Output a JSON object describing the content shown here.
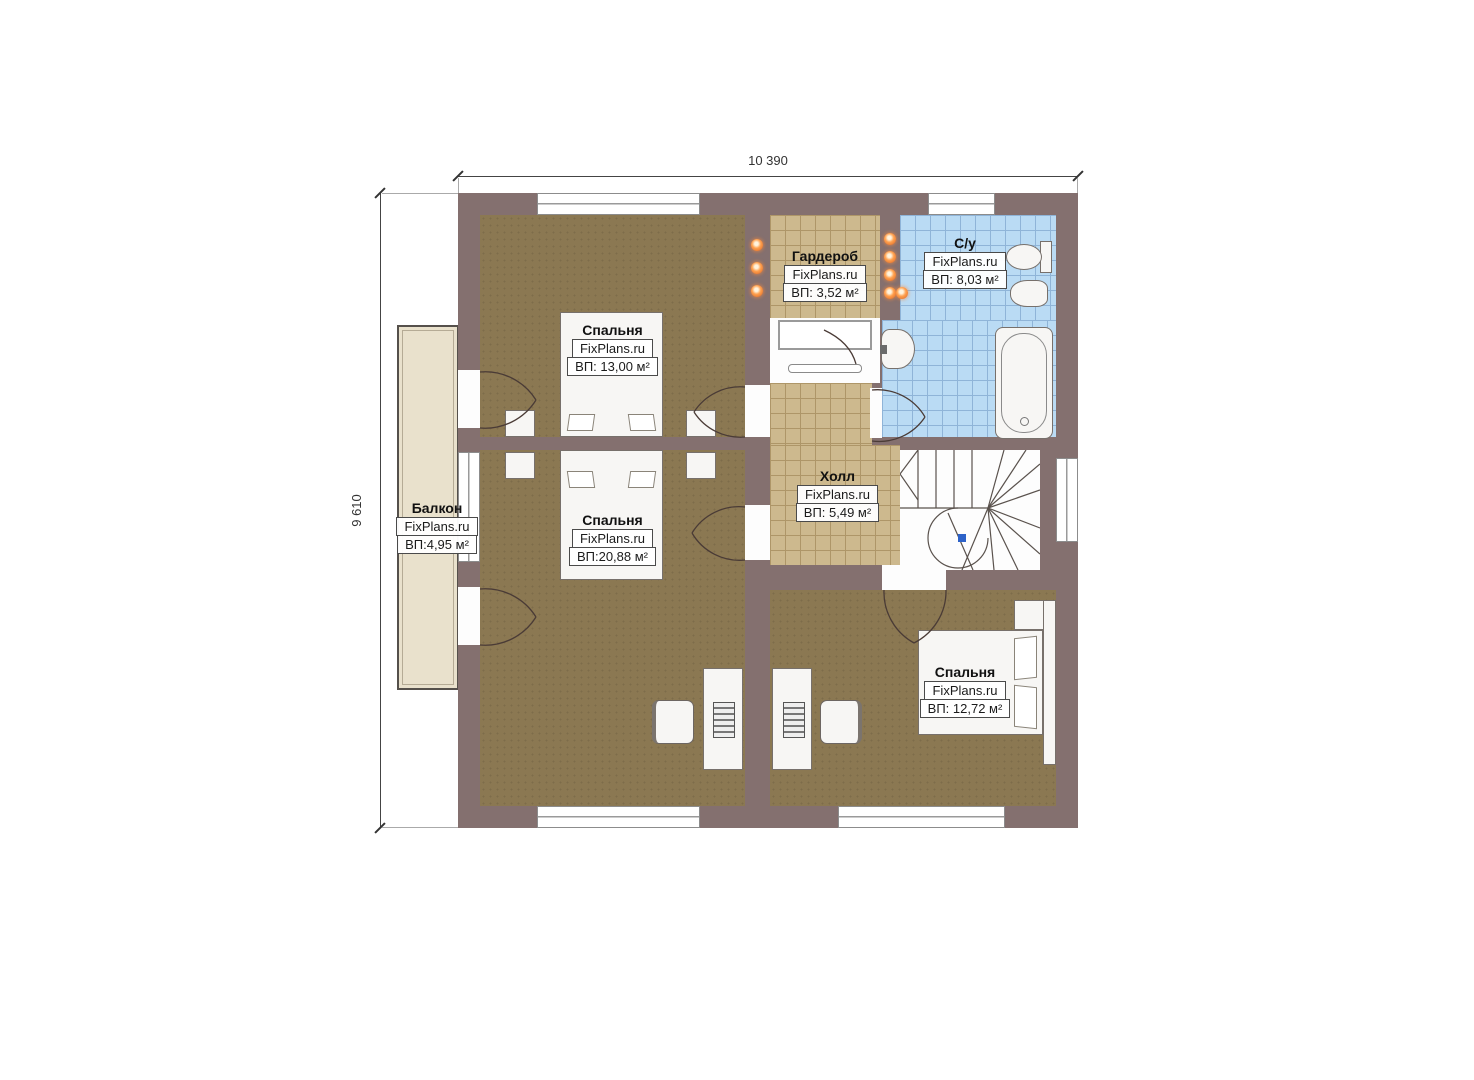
{
  "plan": {
    "type": "floor-plan",
    "dimensions": {
      "width_label": "10 390",
      "height_label": "9 610"
    },
    "watermark": "FixPlans.ru",
    "rooms": {
      "bedroom_top": {
        "name": "Спальня",
        "area": "ВП: 13,00 м²"
      },
      "bedroom_mid": {
        "name": "Спальня",
        "area": "ВП:20,88 м²"
      },
      "wardrobe": {
        "name": "Гардероб",
        "area": "ВП: 3,52 м²"
      },
      "bathroom": {
        "name": "С/у",
        "area": "ВП: 8,03 м²"
      },
      "hall": {
        "name": "Холл",
        "area": "ВП: 5,49 м²"
      },
      "bedroom_right": {
        "name": "Спальня",
        "area": "ВП: 12,72 м²"
      },
      "balcony": {
        "name": "Балкон",
        "area": "ВП:4,95 м²"
      }
    },
    "colors": {
      "wall": "#84706f",
      "bedroom_floor": "#8b7852",
      "tile": "#cdb98e",
      "tile_line": "#ae9668",
      "bath_tile": "#badbf4",
      "bath_tile_line": "#8fb4d8",
      "balcony_slab": "#e9e1cc",
      "accent_vent": "#d9601e",
      "stair_marker": "#2d62c8"
    }
  }
}
